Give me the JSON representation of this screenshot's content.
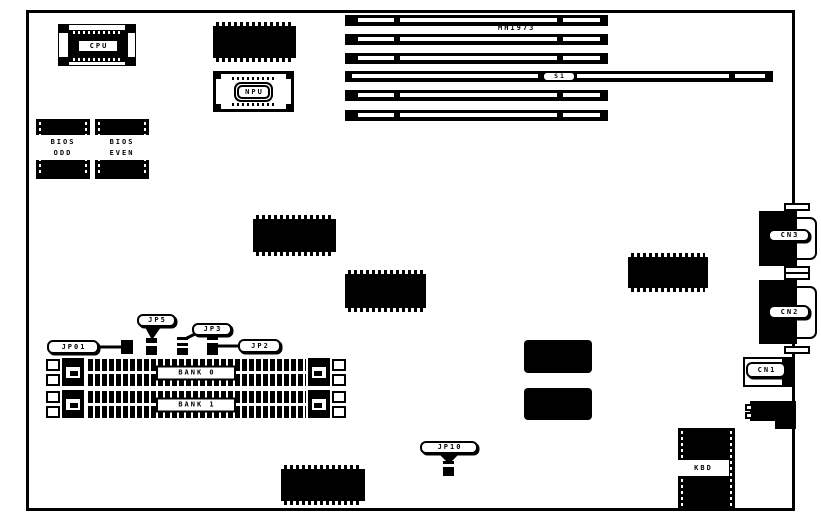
{
  "chips": {
    "cpu": "CPU",
    "npu": "NPU",
    "bios_odd": [
      "BIOS",
      "ODD"
    ],
    "bios_even": [
      "BIOS",
      "EVEN"
    ],
    "keyboard_controller": "KBD"
  },
  "slot_labels": {
    "model": "MH1973",
    "s1": "S1"
  },
  "jumpers": [
    {
      "label": "JP01"
    },
    {
      "label": "JP5"
    },
    {
      "label": "JP3"
    },
    {
      "label": "JP2"
    },
    {
      "label": "JP10"
    }
  ],
  "memory_banks": [
    {
      "label": "BANK 0"
    },
    {
      "label": "BANK 1"
    }
  ],
  "connectors": [
    {
      "label": "CN3"
    },
    {
      "label": "CN2"
    },
    {
      "label": "CN1"
    }
  ],
  "colors": {
    "ink": "#000000",
    "paper": "#ffffff"
  }
}
